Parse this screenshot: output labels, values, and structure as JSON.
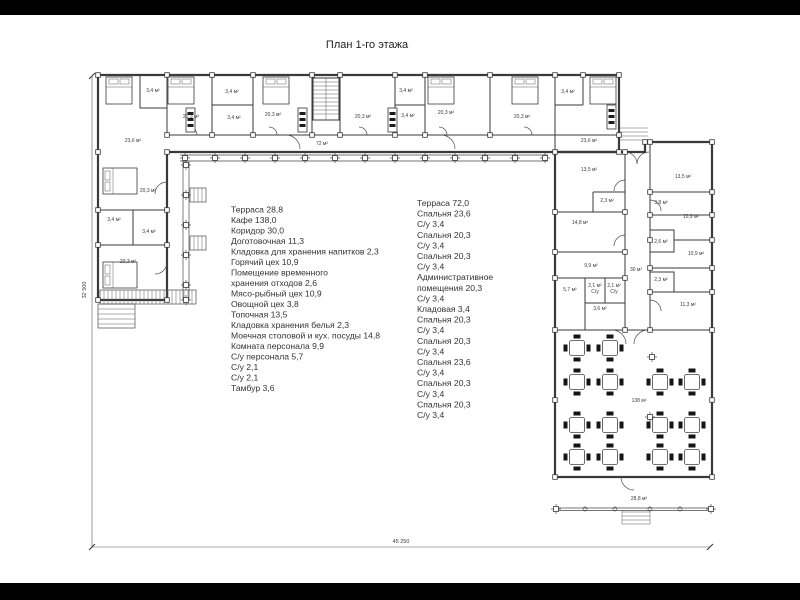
{
  "title": "План 1-го этажа",
  "dimensions": {
    "width": "45 250",
    "height": "32 500"
  },
  "legend": {
    "left": [
      "Терраса 28,8",
      "Кафе 138,0",
      "Коридор 30,0",
      "Доготовочная 11,3",
      "Кладовка для хранения напитков 2,3",
      "Горячий цех 10,9",
      "Помещение временного",
      "хранения отходов 2,6",
      "Мясо-рыбный цех 10,9",
      "Овощной цех 3,8",
      "Топочная 13,5",
      "Кладовка хранения белья 2,3",
      "Моечная столовой и кух. посуды 14,8",
      "Комната персонала 9,9",
      "С/у персонала 5,7",
      "С/у 2,1",
      "С/у 2,1",
      "Тамбур 3,6"
    ],
    "right": [
      "Терраса 72,0",
      "Спальня 23,6",
      "С/у 3,4",
      "Спальня 20,3",
      "С/у 3,4",
      "Спальня 20,3",
      "С/у 3,4",
      "Административное",
      "помещения 20,3",
      "С/у 3,4",
      "Кладовая 3,4",
      "Спальня 20,3",
      "С/у 3,4",
      "Спальня 20,3",
      "С/у 3,4",
      "Спальня 23,6",
      "С/у 3,4",
      "Спальня 20,3",
      "С/у 3,4",
      "Спальня 20,3",
      "С/у 3,4"
    ]
  },
  "plan": {
    "room_labels": [
      {
        "t": "3,4 м²",
        "x": 153,
        "y": 92
      },
      {
        "t": "20,3 м²",
        "x": 191,
        "y": 118
      },
      {
        "t": "3,4 м²",
        "x": 232,
        "y": 93
      },
      {
        "t": "3,4 м²",
        "x": 234,
        "y": 119
      },
      {
        "t": "20,3 м²",
        "x": 273,
        "y": 116
      },
      {
        "t": "72 м²",
        "x": 322,
        "y": 145
      },
      {
        "t": "20,3 м²",
        "x": 363,
        "y": 118
      },
      {
        "t": "3,4 м²",
        "x": 406,
        "y": 92
      },
      {
        "t": "3,4 м²",
        "x": 408,
        "y": 117
      },
      {
        "t": "20,3 м²",
        "x": 446,
        "y": 114
      },
      {
        "t": "20,3 м²",
        "x": 522,
        "y": 118
      },
      {
        "t": "3,4 м²",
        "x": 568,
        "y": 93
      },
      {
        "t": "23,6 м²",
        "x": 133,
        "y": 142
      },
      {
        "t": "23,6 м²",
        "x": 589,
        "y": 142
      },
      {
        "t": "20,3 м²",
        "x": 148,
        "y": 192
      },
      {
        "t": "3,4 м²",
        "x": 114,
        "y": 221
      },
      {
        "t": "3,4 м²",
        "x": 149,
        "y": 233
      },
      {
        "t": "20,3 м²",
        "x": 128,
        "y": 263
      },
      {
        "t": "13,5 м²",
        "x": 589,
        "y": 171
      },
      {
        "t": "13,5 м²",
        "x": 683,
        "y": 178
      },
      {
        "t": "2,3 м²",
        "x": 607,
        "y": 202
      },
      {
        "t": "3,8 м²",
        "x": 661,
        "y": 204
      },
      {
        "t": "14,8 м²",
        "x": 580,
        "y": 224
      },
      {
        "t": "10,9 м²",
        "x": 691,
        "y": 218
      },
      {
        "t": "2,6 м²",
        "x": 661,
        "y": 243
      },
      {
        "t": "10,9 м²",
        "x": 696,
        "y": 255
      },
      {
        "t": "9,9 м²",
        "x": 591,
        "y": 267
      },
      {
        "t": "30 м²",
        "x": 636,
        "y": 271
      },
      {
        "t": "2,3 м²",
        "x": 661,
        "y": 281
      },
      {
        "t": "5,7 м²",
        "x": 570,
        "y": 291
      },
      {
        "t": "2,1 м²",
        "x": 595,
        "y": 287
      },
      {
        "t": "С/у",
        "x": 595,
        "y": 293
      },
      {
        "t": "2,1 м²",
        "x": 614,
        "y": 287
      },
      {
        "t": "С/у",
        "x": 614,
        "y": 293
      },
      {
        "t": "3,6 м²",
        "x": 600,
        "y": 310
      },
      {
        "t": "11,3 м²",
        "x": 688,
        "y": 306
      },
      {
        "t": "138 м²",
        "x": 639,
        "y": 402
      },
      {
        "t": "28,8 м²",
        "x": 639,
        "y": 500
      }
    ],
    "beds": [
      {
        "x": 106,
        "y": 77,
        "o": "v"
      },
      {
        "x": 168,
        "y": 77,
        "o": "v"
      },
      {
        "x": 263,
        "y": 77,
        "o": "v"
      },
      {
        "x": 428,
        "y": 77,
        "o": "v"
      },
      {
        "x": 512,
        "y": 77,
        "o": "v"
      },
      {
        "x": 590,
        "y": 77,
        "o": "v"
      },
      {
        "x": 103,
        "y": 168,
        "o": "h"
      },
      {
        "x": 103,
        "y": 262,
        "o": "h"
      }
    ],
    "closets": [
      [
        186,
        108
      ],
      [
        298,
        108
      ],
      [
        388,
        108
      ],
      [
        607,
        105
      ]
    ],
    "cafe_tables": [
      [
        577,
        348
      ],
      [
        610,
        348
      ],
      [
        577,
        382
      ],
      [
        610,
        382
      ],
      [
        660,
        382
      ],
      [
        692,
        382
      ],
      [
        577,
        425
      ],
      [
        610,
        425
      ],
      [
        660,
        425
      ],
      [
        692,
        425
      ],
      [
        577,
        457
      ],
      [
        610,
        457
      ],
      [
        660,
        457
      ],
      [
        692,
        457
      ]
    ],
    "cafe_columns": [
      [
        652,
        357
      ],
      [
        650,
        417
      ]
    ],
    "columns_top": {
      "y": 158,
      "xs": [
        185,
        215,
        245,
        275,
        305,
        335,
        365,
        395,
        425,
        455,
        485,
        515,
        545
      ]
    },
    "columns_left": {
      "x": 186,
      "ys": [
        165,
        195,
        225,
        255,
        285,
        300
      ]
    },
    "terrace_circles": {
      "y": 509,
      "xs": [
        585,
        615,
        650,
        680
      ]
    },
    "wall_markers": [
      [
        98,
        75
      ],
      [
        167,
        75
      ],
      [
        212,
        75
      ],
      [
        253,
        75
      ],
      [
        312,
        75
      ],
      [
        340,
        75
      ],
      [
        395,
        75
      ],
      [
        425,
        75
      ],
      [
        490,
        75
      ],
      [
        555,
        75
      ],
      [
        583,
        75
      ],
      [
        619,
        75
      ],
      [
        98,
        152
      ],
      [
        98,
        210
      ],
      [
        98,
        245
      ],
      [
        98,
        300
      ],
      [
        167,
        300
      ],
      [
        167,
        245
      ],
      [
        167,
        210
      ],
      [
        167,
        152
      ],
      [
        167,
        135
      ],
      [
        212,
        135
      ],
      [
        253,
        135
      ],
      [
        312,
        135
      ],
      [
        340,
        135
      ],
      [
        395,
        135
      ],
      [
        425,
        135
      ],
      [
        490,
        135
      ],
      [
        619,
        135
      ],
      [
        619,
        152
      ],
      [
        645,
        142
      ],
      [
        712,
        142
      ],
      [
        555,
        152
      ],
      [
        555,
        212
      ],
      [
        555,
        252
      ],
      [
        555,
        278
      ],
      [
        555,
        330
      ],
      [
        555,
        400
      ],
      [
        555,
        477
      ],
      [
        625,
        152
      ],
      [
        625,
        212
      ],
      [
        625,
        252
      ],
      [
        625,
        278
      ],
      [
        625,
        330
      ],
      [
        650,
        142
      ],
      [
        650,
        192
      ],
      [
        650,
        215
      ],
      [
        650,
        240
      ],
      [
        650,
        268
      ],
      [
        650,
        292
      ],
      [
        650,
        330
      ],
      [
        712,
        192
      ],
      [
        712,
        215
      ],
      [
        712,
        240
      ],
      [
        712,
        268
      ],
      [
        712,
        292
      ],
      [
        712,
        330
      ],
      [
        712,
        400
      ],
      [
        712,
        477
      ]
    ]
  }
}
